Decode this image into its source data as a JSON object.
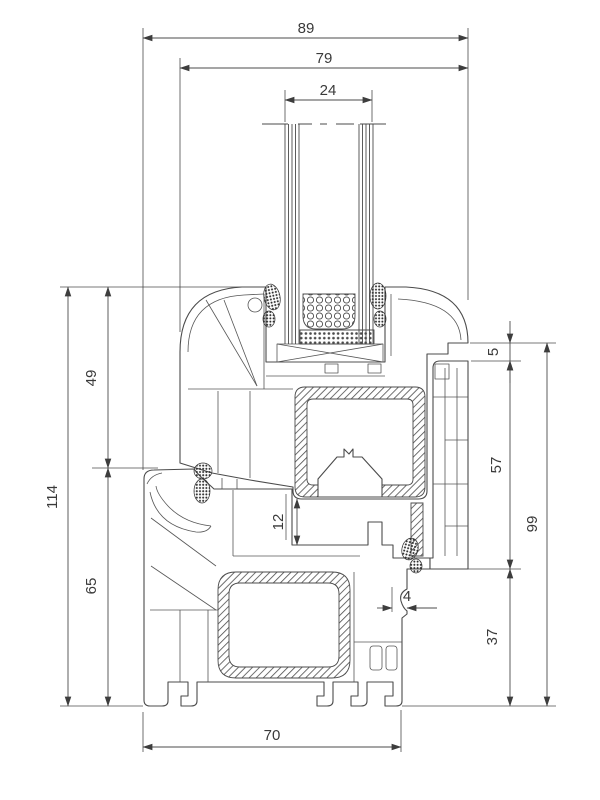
{
  "drawing": {
    "dimensions": {
      "overall_width": "89",
      "sash_width": "79",
      "glazing_thickness": "24",
      "sash_height": "49",
      "total_height": "114",
      "frame_left_height": "65",
      "sash_frame_overlap": "5",
      "frame_rebate_height": "57",
      "frame_base_height": "37",
      "frame_right_height": "99",
      "rebate_clearance": "12",
      "edge_offset": "4",
      "frame_depth": "70"
    },
    "colors": {
      "line": "#4a4a4a",
      "background": "#ffffff"
    }
  }
}
